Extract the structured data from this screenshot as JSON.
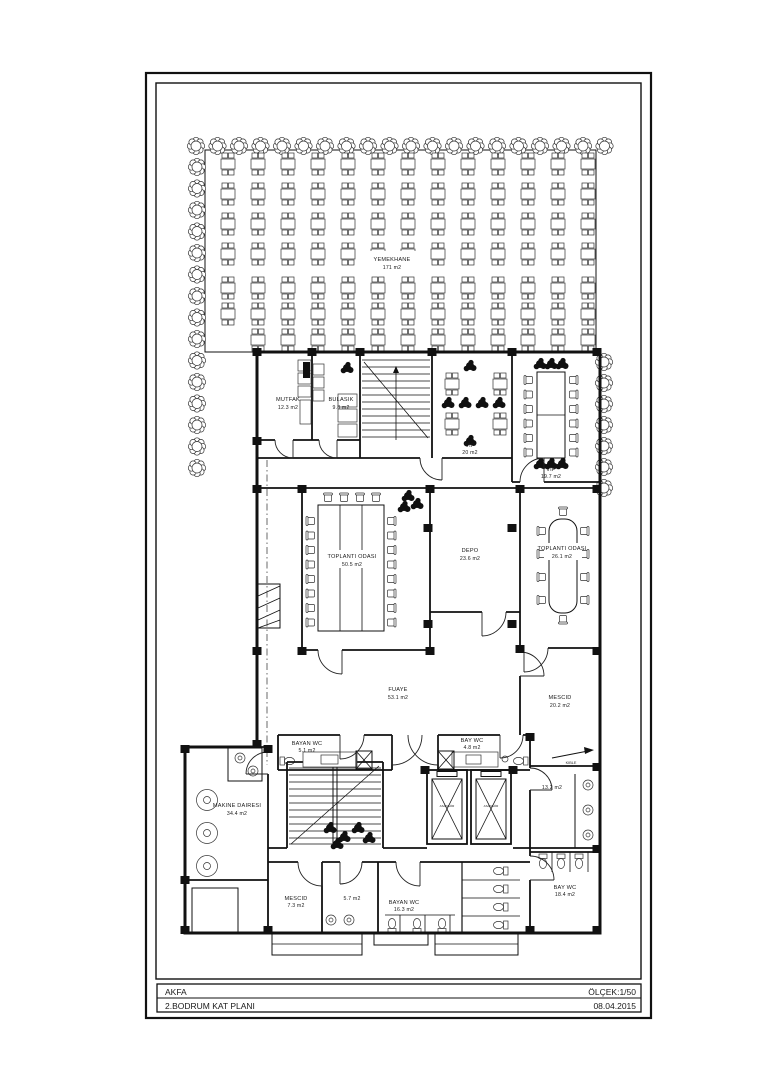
{
  "title_block": {
    "firm": "AKFA",
    "scale": "ÖLÇEK:1/50",
    "drawing": "2.BODRUM KAT PLANI",
    "date": "08.04.2015"
  },
  "rooms": {
    "yemekhane": {
      "name": "YEMEKHANE",
      "area": "171 m2"
    },
    "mutfak": {
      "name": "MUTFAK",
      "area": "12.3 m2"
    },
    "bulasik": {
      "name": "BULASIK",
      "area": "9.8 m2"
    },
    "vip1": {
      "name": "VIP",
      "area": "20 m2"
    },
    "vip2": {
      "name": "VIP",
      "area": "19.7 m2"
    },
    "toplanti1": {
      "name": "TOPLANTI ODASI",
      "area": "50.5 m2"
    },
    "depo": {
      "name": "DEPO",
      "area": "23.6 m2"
    },
    "toplanti2": {
      "name": "TOPLANTI ODASI",
      "area": "26.1 m2"
    },
    "fuaye": {
      "name": "FUAYE",
      "area": "53.1 m2"
    },
    "mescid1": {
      "name": "MESCID",
      "area": "20.2 m2"
    },
    "bayan_wc1": {
      "name": "BAYAN WC",
      "area": "5.1 m2"
    },
    "bay_wc1": {
      "name": "BAY WC",
      "area": "4.8 m2"
    },
    "oda132": {
      "area": "13.2 m2"
    },
    "makine": {
      "name": "MAKINE DAIRESI",
      "area": "34.4 m2"
    },
    "mescid2": {
      "name": "MESCID",
      "area": "7.3 m2"
    },
    "oda57": {
      "area": "5.7 m2"
    },
    "bayan_wc2": {
      "name": "BAYAN WC",
      "area": "16.3 m2"
    },
    "bay_wc2": {
      "name": "BAY WC",
      "area": "18.4 m2"
    }
  },
  "annotations": {
    "kible": "KIBLE",
    "asansor": "ASANSÖR"
  },
  "plan": {
    "furniture": [
      {
        "s": "tree",
        "x": 196,
        "y": 146,
        "n": 20,
        "dx": 21.5
      },
      {
        "s": "tree",
        "x": 197,
        "y": 167,
        "n": 15,
        "dy": 21.5
      },
      {
        "s": "tree",
        "x": 604,
        "y": 362,
        "n": 7,
        "dy": 21
      },
      {
        "s": "table4",
        "x": 228,
        "y": 164,
        "n": 13,
        "dx": 30
      },
      {
        "s": "table4",
        "x": 228,
        "y": 194,
        "n": 13,
        "dx": 30
      },
      {
        "s": "table4",
        "x": 228,
        "y": 224,
        "n": 13,
        "dx": 30
      },
      {
        "s": "table4",
        "x": 228,
        "y": 254,
        "n": 13,
        "dx": 30
      },
      {
        "s": "table4",
        "x": 228,
        "y": 288,
        "n": 13,
        "dx": 30
      },
      {
        "s": "table4",
        "x": 228,
        "y": 314,
        "n": 13,
        "dx": 30
      },
      {
        "s": "table4",
        "x": 258,
        "y": 340,
        "n": 12,
        "dx": 30
      },
      {
        "s": "table4",
        "x": 452,
        "y": 384
      },
      {
        "s": "table4",
        "x": 500,
        "y": 384
      },
      {
        "s": "table4",
        "x": 452,
        "y": 424
      },
      {
        "s": "table4",
        "x": 500,
        "y": 424
      },
      {
        "s": "darkplant",
        "x": 470,
        "y": 366
      },
      {
        "s": "darkplant",
        "x": 448,
        "y": 403,
        "n": 4,
        "dx": 17
      },
      {
        "s": "darkplant",
        "x": 470,
        "y": 441
      },
      {
        "s": "darkplant",
        "x": 540,
        "y": 364,
        "n": 3,
        "dx": 11
      },
      {
        "s": "darkplant",
        "x": 540,
        "y": 464,
        "n": 3,
        "dx": 11
      },
      {
        "s": "chair",
        "x": 529,
        "y": 380,
        "n": 6,
        "dy": 14.5,
        "rot": -90
      },
      {
        "s": "chair",
        "x": 573,
        "y": 380,
        "n": 6,
        "dy": 14.5,
        "rot": 90
      },
      {
        "s": "chair",
        "x": 328,
        "y": 498,
        "n": 4,
        "dx": 16
      },
      {
        "s": "chair",
        "x": 311,
        "y": 521,
        "n": 8,
        "dy": 14.5,
        "rot": -90
      },
      {
        "s": "chair",
        "x": 391,
        "y": 521,
        "n": 8,
        "dy": 14.5,
        "rot": 90
      },
      {
        "s": "darkplant",
        "x": 408,
        "y": 496
      },
      {
        "s": "darkplant",
        "x": 417,
        "y": 504
      },
      {
        "s": "darkplant",
        "x": 404,
        "y": 507
      },
      {
        "s": "chair",
        "x": 563,
        "y": 512
      },
      {
        "s": "chair",
        "x": 563,
        "y": 619,
        "rot": 180
      },
      {
        "s": "chair",
        "x": 542,
        "y": 531,
        "n": 4,
        "dy": 23,
        "rot": -90
      },
      {
        "s": "chair",
        "x": 584,
        "y": 531,
        "n": 4,
        "dy": 23,
        "rot": 90
      },
      {
        "s": "machine",
        "x": 207,
        "y": 800
      },
      {
        "s": "machine",
        "x": 207,
        "y": 833
      },
      {
        "s": "machine",
        "x": 207,
        "y": 866
      },
      {
        "s": "sinkc",
        "x": 240,
        "y": 758
      },
      {
        "s": "sinkc",
        "x": 253,
        "y": 771
      },
      {
        "s": "darkplant",
        "x": 330,
        "y": 828
      },
      {
        "s": "darkplant",
        "x": 344,
        "y": 837
      },
      {
        "s": "darkplant",
        "x": 358,
        "y": 828
      },
      {
        "s": "darkplant",
        "x": 369,
        "y": 838
      },
      {
        "s": "darkplant",
        "x": 337,
        "y": 844
      },
      {
        "s": "darkplant",
        "x": 347,
        "y": 368
      },
      {
        "s": "toilet",
        "x": 288,
        "y": 761,
        "rot": -90
      },
      {
        "s": "toilet",
        "x": 520,
        "y": 761,
        "rot": 90
      },
      {
        "s": "toilet",
        "x": 500,
        "y": 871,
        "n": 4,
        "dy": 18,
        "rot": 90
      },
      {
        "s": "toilet",
        "x": 392,
        "y": 925,
        "n": 3,
        "dx": 25,
        "rot": 180
      },
      {
        "s": "toilet",
        "x": 543,
        "y": 862,
        "n": 3,
        "dx": 18
      },
      {
        "s": "sinkc",
        "x": 331,
        "y": 920
      },
      {
        "s": "sinkc",
        "x": 349,
        "y": 920
      },
      {
        "s": "sinkc",
        "x": 588,
        "y": 785,
        "n": 3,
        "dy": 25
      }
    ],
    "columns": [
      [
        257,
        352
      ],
      [
        312,
        352
      ],
      [
        360,
        352
      ],
      [
        432,
        352
      ],
      [
        512,
        352
      ],
      [
        597,
        352
      ],
      [
        257,
        441
      ],
      [
        257,
        489
      ],
      [
        257,
        651
      ],
      [
        257,
        744
      ],
      [
        597,
        489
      ],
      [
        597,
        651
      ],
      [
        597,
        767
      ],
      [
        597,
        849
      ],
      [
        597,
        930
      ],
      [
        302,
        489
      ],
      [
        430,
        489
      ],
      [
        520,
        489
      ],
      [
        302,
        651
      ],
      [
        430,
        651
      ],
      [
        520,
        649
      ],
      [
        428,
        528
      ],
      [
        428,
        624
      ],
      [
        512,
        528
      ],
      [
        512,
        624
      ],
      [
        185,
        749
      ],
      [
        185,
        880
      ],
      [
        185,
        930
      ],
      [
        268,
        749
      ],
      [
        268,
        930
      ],
      [
        425,
        770
      ],
      [
        513,
        770
      ],
      [
        530,
        737
      ],
      [
        530,
        930
      ]
    ]
  }
}
